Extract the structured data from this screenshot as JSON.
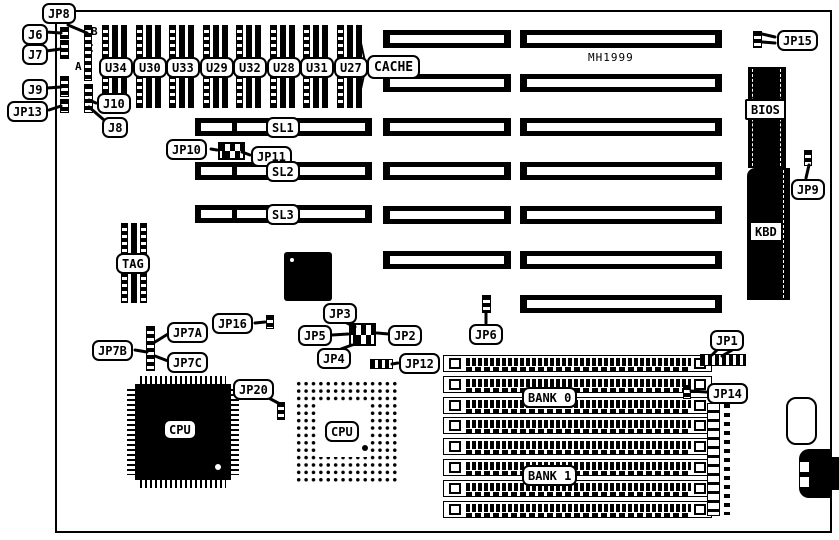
{
  "diagram": {
    "kind": "motherboard jumper/component location diagram",
    "board_note": {
      "text": "MH1999",
      "x": 588,
      "y": 51
    },
    "colors": {
      "ink": "#000000",
      "paper": "#ffffff"
    }
  },
  "board": {
    "x": 55,
    "y": 10,
    "w": 777,
    "h": 523
  },
  "callouts": [
    {
      "id": "jp8",
      "text": "JP8",
      "x": 42,
      "y": 3,
      "lines": [
        [
          68,
          25,
          87,
          33
        ]
      ]
    },
    {
      "id": "j6",
      "text": "J6",
      "x": 22,
      "y": 24,
      "lines": [
        [
          46,
          32,
          61,
          33
        ]
      ]
    },
    {
      "id": "j7",
      "text": "J7",
      "x": 22,
      "y": 44,
      "lines": [
        [
          46,
          51,
          61,
          49
        ]
      ]
    },
    {
      "id": "j9",
      "text": "J9",
      "x": 22,
      "y": 79,
      "lines": [
        [
          47,
          88,
          61,
          87
        ]
      ]
    },
    {
      "id": "jp13",
      "text": "JP13",
      "x": 7,
      "y": 101,
      "lines": [
        [
          49,
          110,
          61,
          106
        ]
      ]
    },
    {
      "id": "j10",
      "text": "J10",
      "x": 97,
      "y": 93,
      "lines": [
        [
          96,
          103,
          89,
          100
        ]
      ]
    },
    {
      "id": "j8",
      "text": "J8",
      "x": 102,
      "y": 117,
      "lines": [
        [
          104,
          120,
          89,
          107
        ]
      ]
    },
    {
      "id": "u34",
      "text": "U34",
      "x": 99,
      "y": 57
    },
    {
      "id": "u30",
      "text": "U30",
      "x": 133,
      "y": 57
    },
    {
      "id": "u33",
      "text": "U33",
      "x": 166,
      "y": 57
    },
    {
      "id": "u29",
      "text": "U29",
      "x": 200,
      "y": 57
    },
    {
      "id": "u32",
      "text": "U32",
      "x": 233,
      "y": 57
    },
    {
      "id": "u28",
      "text": "U28",
      "x": 267,
      "y": 57
    },
    {
      "id": "u31",
      "text": "U31",
      "x": 300,
      "y": 57
    },
    {
      "id": "u27",
      "text": "U27",
      "x": 334,
      "y": 57
    },
    {
      "id": "cache",
      "text": "CACHE",
      "x": 367,
      "y": 55,
      "big": 1
    },
    {
      "id": "jp15",
      "text": "JP15",
      "x": 777,
      "y": 30,
      "lines": [
        [
          775,
          37,
          762,
          34
        ],
        [
          775,
          43,
          762,
          42
        ]
      ]
    },
    {
      "id": "bios",
      "text": "BIOS",
      "x": 745,
      "y": 99,
      "sq": 1
    },
    {
      "id": "jp9",
      "text": "JP9",
      "x": 791,
      "y": 179,
      "lines": [
        [
          806,
          178,
          809,
          165
        ]
      ]
    },
    {
      "id": "kbd",
      "text": "KBD",
      "x": 749,
      "y": 221,
      "sq": 1
    },
    {
      "id": "jp10",
      "text": "JP10",
      "x": 166,
      "y": 139,
      "lines": [
        [
          211,
          149,
          217,
          150
        ]
      ]
    },
    {
      "id": "jp11",
      "text": "JP11",
      "x": 251,
      "y": 146,
      "lines": [
        [
          250,
          155,
          242,
          152
        ]
      ]
    },
    {
      "id": "sl1",
      "text": "SL1",
      "x": 266,
      "y": 117
    },
    {
      "id": "sl2",
      "text": "SL2",
      "x": 266,
      "y": 161
    },
    {
      "id": "sl3",
      "text": "SL3",
      "x": 266,
      "y": 204
    },
    {
      "id": "tag",
      "text": "TAG",
      "x": 116,
      "y": 253
    },
    {
      "id": "jp16",
      "text": "JP16",
      "x": 212,
      "y": 313,
      "lines": [
        [
          255,
          323,
          265,
          322
        ]
      ]
    },
    {
      "id": "jp7a",
      "text": "JP7A",
      "x": 167,
      "y": 322,
      "lines": [
        [
          168,
          334,
          155,
          342
        ]
      ]
    },
    {
      "id": "jp7b",
      "text": "JP7B",
      "x": 92,
      "y": 340,
      "lines": [
        [
          135,
          350,
          147,
          352
        ]
      ]
    },
    {
      "id": "jp7c",
      "text": "JP7C",
      "x": 167,
      "y": 352,
      "lines": [
        [
          168,
          361,
          155,
          356
        ]
      ]
    },
    {
      "id": "jp3",
      "text": "JP3",
      "x": 323,
      "y": 303,
      "lines": [
        [
          343,
          321,
          355,
          327
        ]
      ]
    },
    {
      "id": "jp5",
      "text": "JP5",
      "x": 298,
      "y": 325,
      "lines": [
        [
          332,
          335,
          348,
          334
        ]
      ]
    },
    {
      "id": "jp2",
      "text": "JP2",
      "x": 388,
      "y": 325,
      "lines": [
        [
          389,
          334,
          377,
          333
        ]
      ]
    },
    {
      "id": "jp4",
      "text": "JP4",
      "x": 317,
      "y": 348,
      "lines": [
        [
          341,
          349,
          352,
          345
        ]
      ]
    },
    {
      "id": "jp6",
      "text": "JP6",
      "x": 469,
      "y": 324,
      "lines": [
        [
          486,
          323,
          486,
          312
        ]
      ]
    },
    {
      "id": "jp12",
      "text": "JP12",
      "x": 399,
      "y": 353,
      "lines": [
        [
          398,
          363,
          392,
          364
        ]
      ]
    },
    {
      "id": "jp20",
      "text": "JP20",
      "x": 233,
      "y": 379,
      "lines": [
        [
          265,
          396,
          280,
          404
        ]
      ]
    },
    {
      "id": "cpu-qfp-label",
      "text": "CPU",
      "x": 163,
      "y": 419
    },
    {
      "id": "cpu-pga-label",
      "text": "CPU",
      "x": 325,
      "y": 421
    },
    {
      "id": "jp1",
      "text": "JP1",
      "x": 710,
      "y": 330,
      "lines": [
        [
          718,
          349,
          712,
          355
        ],
        [
          734,
          349,
          722,
          356
        ]
      ]
    },
    {
      "id": "jp14",
      "text": "JP14",
      "x": 707,
      "y": 383,
      "lines": [
        [
          706,
          392,
          691,
          391
        ]
      ]
    },
    {
      "id": "bank0",
      "text": "BANK 0",
      "x": 522,
      "y": 387
    },
    {
      "id": "bank1",
      "text": "BANK 1",
      "x": 522,
      "y": 465
    }
  ],
  "letters": [
    {
      "t": "B",
      "x": 91,
      "y": 26
    },
    {
      "t": "C",
      "x": 87,
      "y": 43
    },
    {
      "t": "A",
      "x": 75,
      "y": 61
    }
  ],
  "chips": {
    "dip_row": {
      "names": [
        "U34",
        "U30",
        "U33",
        "U29",
        "U32",
        "U28",
        "U31",
        "U27"
      ],
      "first_x": 102,
      "pitch": 33.5,
      "y": 25,
      "w": 25,
      "h": 83
    },
    "tag_chip": {
      "x": 121,
      "y": 223,
      "w": 26,
      "h": 80
    },
    "qfp_small": {
      "x": 284,
      "y": 252,
      "w": 48,
      "h": 49,
      "dot": [
        290,
        258
      ]
    },
    "cpu_qfp": {
      "x": 127,
      "y": 376,
      "w": 112,
      "h": 112,
      "dot": [
        215,
        464
      ]
    },
    "cpu_pga": {
      "x": 293,
      "y": 378,
      "w": 104,
      "h": 104,
      "inner": [
        317,
        402,
        53,
        55
      ],
      "dot": [
        362,
        445
      ]
    },
    "bios_chip": {
      "x": 748,
      "y": 67,
      "w": 38,
      "h": 101
    },
    "kbd_chip": {
      "x": 747,
      "y": 168,
      "w": 43,
      "h": 132
    }
  },
  "slots": {
    "h": 18,
    "left": {
      "x": 195,
      "w": 177,
      "rows": [
        118,
        162,
        205
      ],
      "labels": [
        "SL1",
        "SL2",
        "SL3"
      ]
    },
    "mid": {
      "x": 383,
      "w": 128,
      "rows": [
        30,
        74,
        118,
        162,
        206,
        251
      ]
    },
    "right": {
      "x": 520,
      "w": 202,
      "rows": [
        30,
        74,
        118,
        162,
        206,
        251,
        295
      ]
    }
  },
  "cache_brace": [
    [
      357,
      25
    ],
    [
      366,
      66
    ],
    [
      357,
      107
    ]
  ],
  "simm_banks": {
    "x": 443,
    "w": 269,
    "h": 17,
    "y0": 355,
    "pitch": 20.8,
    "count": 8,
    "bank0_rows": "1-4",
    "bank1_rows": "5-8"
  },
  "strips": [
    {
      "id": "j6-pins",
      "x": 60,
      "y": 27,
      "w": 9,
      "h": 12
    },
    {
      "id": "j7-pins",
      "x": 60,
      "y": 40,
      "w": 9,
      "h": 19
    },
    {
      "id": "j9-pins",
      "x": 60,
      "y": 76,
      "w": 9,
      "h": 21
    },
    {
      "id": "jp13-pins",
      "x": 60,
      "y": 99,
      "w": 9,
      "h": 14
    },
    {
      "id": "jp8-pins",
      "x": 84,
      "y": 25,
      "w": 8,
      "h": 56
    },
    {
      "id": "j10-j8-pins",
      "x": 84,
      "y": 84,
      "w": 9,
      "h": 29
    },
    {
      "id": "jp7-pins",
      "x": 146,
      "y": 326,
      "w": 9,
      "h": 45
    },
    {
      "id": "jp16-pins",
      "x": 266,
      "y": 315,
      "w": 8,
      "h": 14
    },
    {
      "id": "jp6-pins",
      "x": 482,
      "y": 295,
      "w": 9,
      "h": 18
    },
    {
      "id": "jp15-pins",
      "x": 753,
      "y": 31,
      "w": 9,
      "h": 17
    },
    {
      "id": "jp9-pins",
      "x": 804,
      "y": 150,
      "w": 8,
      "h": 16
    },
    {
      "id": "jp20-pins",
      "x": 277,
      "y": 402,
      "w": 8,
      "h": 18
    },
    {
      "id": "jp14-pins",
      "x": 683,
      "y": 385,
      "w": 8,
      "h": 14
    }
  ],
  "hstrips": [
    {
      "id": "jp12-pins",
      "x": 370,
      "y": 359,
      "w": 23,
      "h": 10
    },
    {
      "id": "jp1-pins",
      "x": 700,
      "y": 354,
      "w": 46,
      "h": 12
    }
  ],
  "blocks": [
    {
      "id": "jp10-jp11-block",
      "x": 218,
      "y": 142,
      "w": 27,
      "h": 18
    },
    {
      "id": "jp2-jp5-jumper-block",
      "x": 349,
      "y": 323,
      "w": 27,
      "h": 23
    }
  ],
  "power_connector": {
    "x": 707,
    "y": 403,
    "w": 26,
    "h": 113
  },
  "battery_outline": {
    "x": 786,
    "y": 397,
    "w": 31,
    "h": 48
  },
  "din_connector": {
    "x": 799,
    "y": 449,
    "w": 33,
    "h": 49,
    "holes": [
      [
        800,
        462
      ],
      [
        800,
        477
      ]
    ]
  }
}
